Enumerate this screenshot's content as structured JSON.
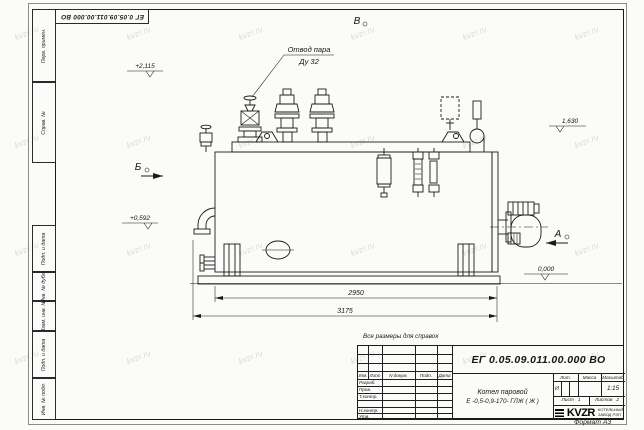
{
  "colors": {
    "line": "#1a1a1a",
    "background": "#fbfbf9",
    "watermark": "#b5b5b5"
  },
  "watermark": {
    "text": "kvzr.ru"
  },
  "sheet": {
    "doc_number_top": "ЕГ 0.05.09.011.00.000  ВО",
    "note": "Все размеры для справок",
    "format_label": "Формат А3"
  },
  "frame": {
    "left_labels": [
      "Перв. примен.",
      "Справ. №",
      "Подп. и дата",
      "Инв. № дубл.",
      "Взам. инв. №",
      "Подп. и дата",
      "Инв. № подл."
    ]
  },
  "annotations": {
    "steam_outlet_line1": "Отвод пара",
    "steam_outlet_line2": "Ду 32",
    "elevation_top": "+2,115",
    "elevation_right": "1,630",
    "elevation_left": "+0,592",
    "elevation_ground": "0,000",
    "view_v": "В",
    "view_b": "Б",
    "view_a": "А",
    "dim_inner": "2950",
    "dim_outer": "3175"
  },
  "title_block": {
    "doc_number": "ЕГ 0.05.09.011.00.000  ВО",
    "header_cols": [
      "Изм.",
      "Лист",
      "N докум.",
      "Подп.",
      "Дата"
    ],
    "rows": [
      "Разраб.",
      "Пров.",
      "Т.контр.",
      "Н.контр.",
      "Утв."
    ],
    "product_name_line1": "Котел паровой",
    "product_name_line2": "Е -0,5-0,9-170- ГЛЖ ( Ж )",
    "lit_label": "Лит.",
    "mass_label": "Масса",
    "scale_label": "Масштаб",
    "lit_value": "И",
    "scale_value": "1:15",
    "sheet_label": "Лист",
    "sheet_value": "1",
    "sheets_label": "Листов",
    "sheets_value": "2",
    "company_logo": "KVZR",
    "company_line1": "КОТЕЛЬНЫЙ",
    "company_line2": "ЗАВОД РЭП"
  }
}
